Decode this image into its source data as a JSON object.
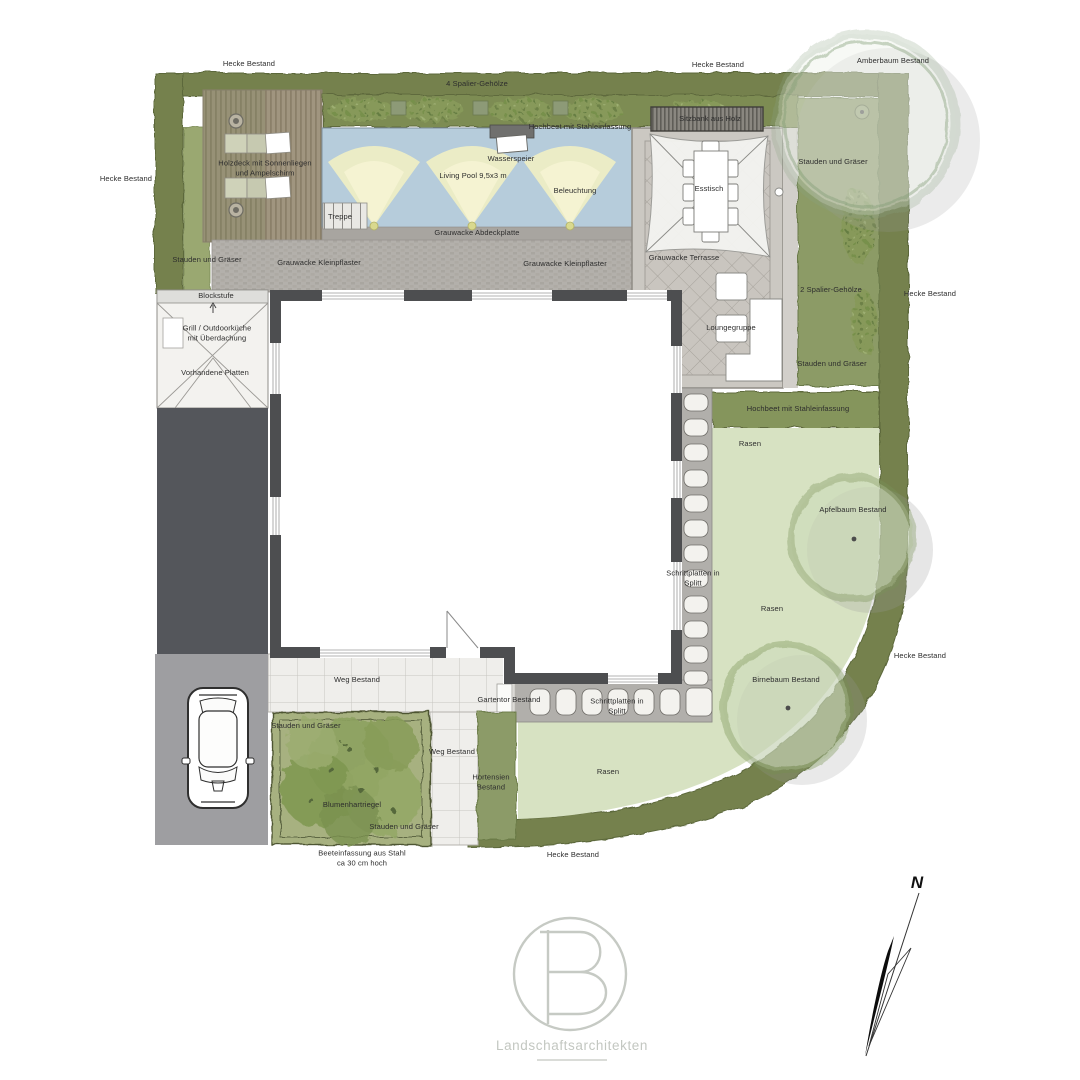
{
  "labels": {
    "hecke_top_left": "Hecke Bestand",
    "hecke_top_right": "Hecke Bestand",
    "amberbaum": "Amberbaum Bestand",
    "hecke_left": "Hecke Bestand",
    "spalier_4": "4 Spalier-Gehölze",
    "hochbeet_top": "Hochbeet mit Stahleinfassung",
    "wasserspeier": "Wasserspeier",
    "living_pool": "Living Pool 9,5x3 m",
    "beleuchtung": "Beleuchtung",
    "treppe": "Treppe",
    "abdeckplatte": "Grauwacke Abdeckplatte",
    "stauden_left": "Stauden und Gräser",
    "kleinpflaster_1": "Grauwacke Kleinpflaster",
    "kleinpflaster_2": "Grauwacke Kleinpflaster",
    "holzdeck": "Holzdeck mit Sonnenliegen\nund Ampelschirm",
    "sitzbank": "Sitzbank aus Holz",
    "esstisch": "Esstisch",
    "terrasse": "Grauwacke Terrasse",
    "loungegruppe": "Loungegruppe",
    "stauden_right_top": "Stauden und Gräser",
    "spalier_2": "2 Spalier-Gehölze",
    "hecke_right_1": "Hecke Bestand",
    "stauden_right_bottom": "Stauden und Gräser",
    "hochbeet_right": "Hochbeet mit Stahleinfassung",
    "rasen_1": "Rasen",
    "apfelbaum": "Apfelbaum Bestand",
    "rasen_2": "Rasen",
    "hecke_right_2": "Hecke Bestand",
    "birnebaum": "Birnebaum Bestand",
    "schrittplatten_1": "Schrittplatten in\nSplitt",
    "schrittplatten_2": "Schrittplatten in\nSplitt",
    "blockstufe": "Blockstufe",
    "grill": "Grill / Outdoorküche\nmit Überdachung",
    "vorhandene_platten": "Vorhandene Platten",
    "weg_1": "Weg Bestand",
    "weg_2": "Weg Bestand",
    "gartentor": "Gartentor Bestand",
    "stauden_bed_top": "Stauden und Gräser",
    "blumenhartriegel": "Blumenhartriegel",
    "stauden_bed_bottom": "Stauden und Gräser",
    "beeteinfassung": "Beeteinfassung aus Stahl\nca 30 cm hoch",
    "hortensien": "Hortensien\nBestand",
    "hecke_bottom": "Hecke Bestand",
    "rasen_3": "Rasen"
  },
  "compass": {
    "north": "N"
  },
  "logo": {
    "letter": "B",
    "name": "Landschaftsarchitekten"
  },
  "colors": {
    "hedge": "#75814d",
    "planting_bed": "#8c9b66",
    "lawn": "#d7e2c2",
    "pool": "#b6ccdb",
    "light_beam": "#f1efc3",
    "deck_wood": "#a0957f",
    "pavers": "#b3b0ab",
    "terrace": "#c9c5bf",
    "house_wall": "#4d4e50",
    "driveway": "#54565b",
    "parking": "#9e9ea1",
    "logo_gray": "#c3c7c1"
  }
}
